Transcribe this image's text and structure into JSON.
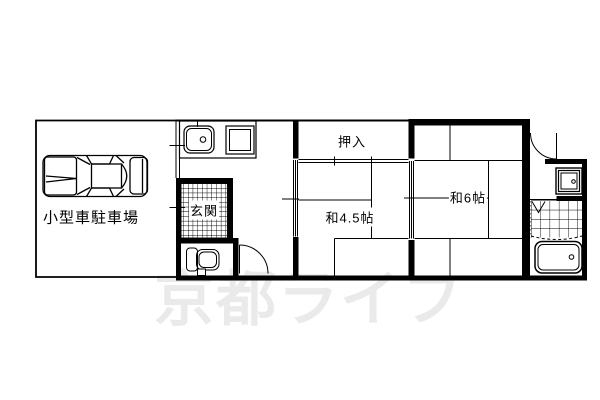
{
  "labels": {
    "parking": "小型車駐車場",
    "entrance": "玄関",
    "closet": "押入",
    "room_4_5": "和4.5帖",
    "room_6": "和6帖"
  },
  "watermark": {
    "text": "京都ライフ",
    "color": "#eaeaea"
  },
  "icons": {
    "car": "car-top-view-icon",
    "kitchen_sink": "kitchen-sink-icon",
    "stove": "stove-icon",
    "toilet": "toilet-icon",
    "washbasin": "washbasin-icon",
    "bathtub": "bathtub-icon"
  },
  "colors": {
    "line": "#000000",
    "background": "#ffffff"
  }
}
